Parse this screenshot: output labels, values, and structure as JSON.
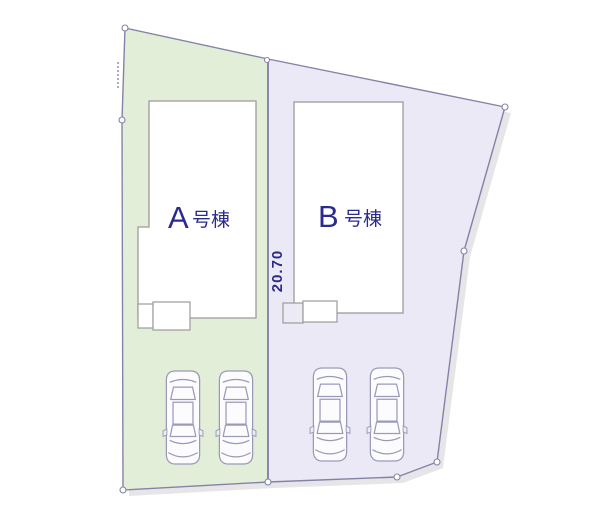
{
  "plan": {
    "type": "site-layout-plan",
    "dimension_label": "20.70",
    "plots": [
      {
        "name": "A",
        "label_letter": "A",
        "label_suffix": "号棟",
        "fill": "#e3eed8",
        "parking_count": 2
      },
      {
        "name": "B",
        "label_letter": "B",
        "label_suffix": "号棟",
        "fill": "#ebe9f6",
        "parking_count": 2
      }
    ],
    "colors": {
      "background": "#ffffff",
      "boundary_line": "#8383a8",
      "building_stroke": "#9b9b9b",
      "building_fill": "#ffffff",
      "label_text": "#2b2b8e",
      "dimension_text": "#2b2b8e",
      "car_outline": "#9a9ab8",
      "shadow": "#e6e6e8"
    }
  }
}
